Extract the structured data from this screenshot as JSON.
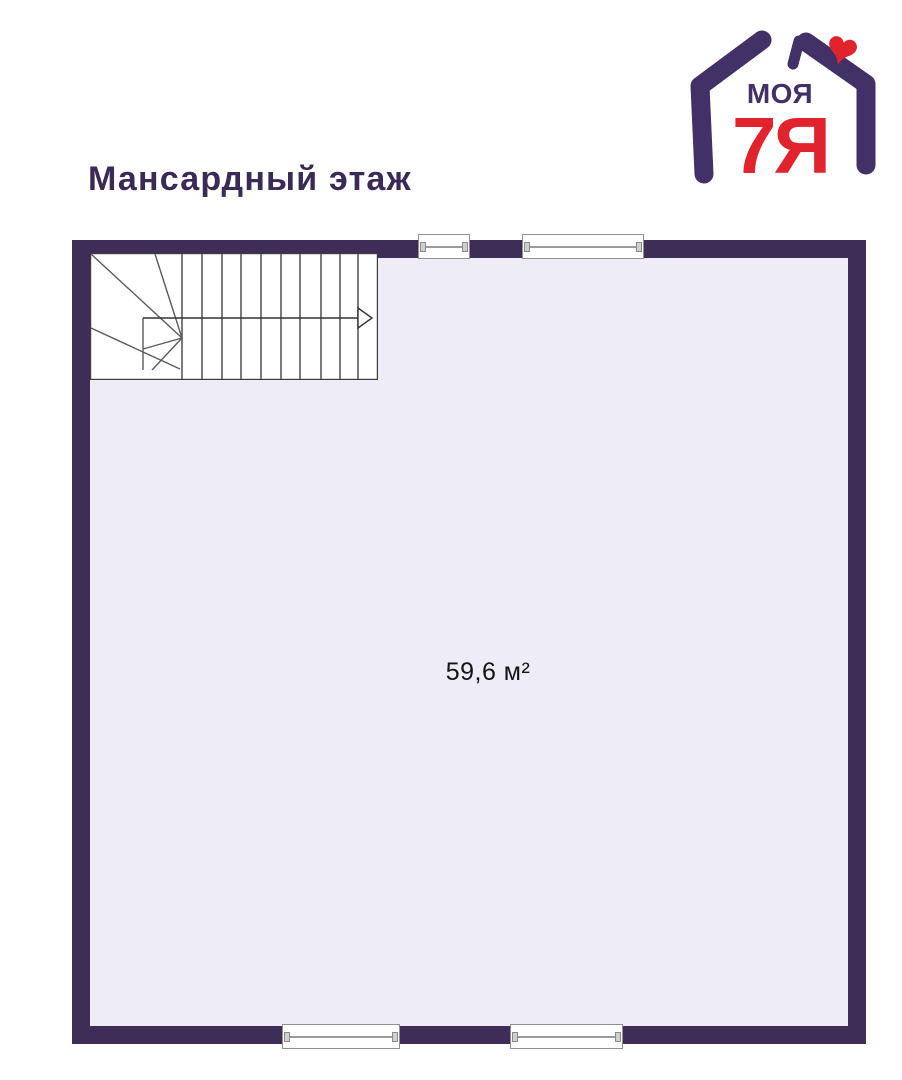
{
  "theme": {
    "wall": "#3d2d57",
    "floor": "#eeecf7",
    "purple": "#423166",
    "red": "#e1232e",
    "title_color": "#3a2a56",
    "stair_line": "#5a5a5a",
    "window_frame": "#8f8f8f"
  },
  "logo": {
    "brand_top": "МОЯ",
    "brand_main": "7Я"
  },
  "header": {
    "title": "Мансардный этаж"
  },
  "plan": {
    "area_label": "59,6 м²"
  }
}
